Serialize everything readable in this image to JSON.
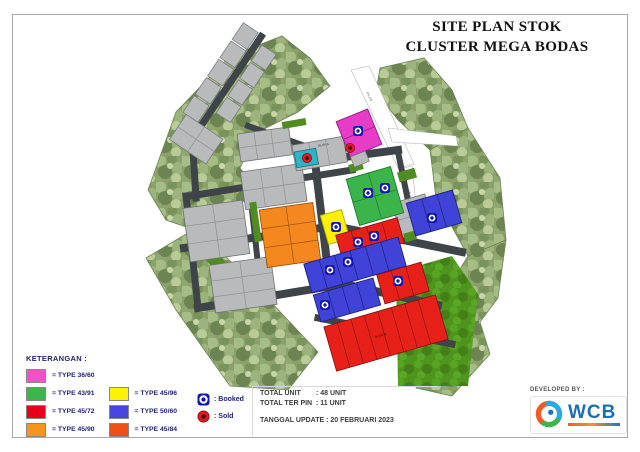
{
  "page": {
    "title_line1": "SITE PLAN STOK",
    "title_line2": "CLUSTER MEGA BODAS"
  },
  "legend": {
    "heading": "KETERANGAN :",
    "items": [
      {
        "label": "= TYPE 36/60",
        "color": "#f050c8"
      },
      {
        "label": "= TYPE 43/91",
        "color": "#3cb54a"
      },
      {
        "label": "= TYPE 45/72",
        "color": "#e8001a"
      },
      {
        "label": "= TYPE 45/90",
        "color": "#f7941e"
      },
      {
        "label": "= TYPE 45/96",
        "color": "#fff200"
      },
      {
        "label": "= TYPE 50/60",
        "color": "#4646e0"
      },
      {
        "label": "= TYPE 45/84",
        "color": "#ef4e17"
      }
    ],
    "status": [
      {
        "label": ": Booked",
        "type": "booked",
        "color": "#1515b0"
      },
      {
        "label": ": Sold",
        "type": "sold",
        "color": "#e31b23"
      }
    ]
  },
  "summary": {
    "rows": [
      {
        "label": "TOTAL UNIT",
        "value": ": 48 UNIT"
      },
      {
        "label": "TOTAL TER PIN",
        "value": ": 11 UNIT"
      }
    ],
    "update_line": "TANGGAL UPDATE : 20 FEBRUARI 2023"
  },
  "developer": {
    "heading": "DEVELOPED BY :",
    "logo_text": "WCB"
  },
  "map": {
    "road_label": "JALAN",
    "block_labels": [
      "BLOK A",
      "BLOK B"
    ],
    "booked_markers": [
      [
        358,
        131
      ],
      [
        368,
        193
      ],
      [
        385,
        188
      ],
      [
        336,
        227
      ],
      [
        358,
        242
      ],
      [
        374,
        236
      ],
      [
        348,
        262
      ],
      [
        330,
        270
      ],
      [
        325,
        305
      ],
      [
        398,
        281
      ],
      [
        432,
        218
      ]
    ],
    "sold_markers": [
      [
        307,
        158
      ],
      [
        350,
        148
      ]
    ],
    "colors": {
      "road": "#3f4449",
      "house_gray": "#b9babc",
      "tree_base": "#8ba169",
      "grass": "#4f941d",
      "white_road": "#ffffff"
    }
  }
}
